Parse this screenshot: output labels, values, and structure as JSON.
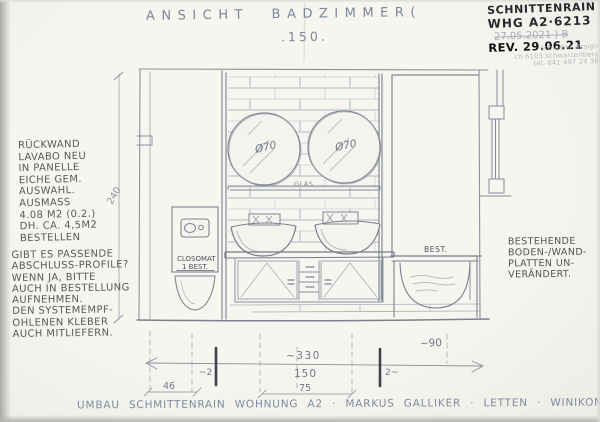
{
  "colors": {
    "paper": "#f3f2ec",
    "pencil": "#868d97",
    "pencil_light": "#c6cad1",
    "ink": "#1c1f23",
    "note_green": "#565e50",
    "title_blue": "#7c8798",
    "stamp_gray": "#b4b9c0"
  },
  "title": {
    "text": "ANSICHT BADZIMMER(",
    "scale": ".150."
  },
  "rev_block": {
    "project": "SCHNITTENRAIN",
    "unit": "WHG A2·6213",
    "old_date": "27.05.2021 ) B",
    "rev": "REV. 29.06.21",
    "stamp": [
      "schindler design",
      "ch-6103 schwarzenberg",
      "tel. 041 497 24 38"
    ]
  },
  "note_left_top": {
    "lines": [
      "RÜCKWAND",
      "LAVABO NEU",
      "IN PANELLE",
      "EICHE GEM.",
      "AUSWAHL.",
      "AUSMASS",
      "4.08 M2 (0.2.)",
      "DH. CA. 4,5M2",
      "BESTELLEN"
    ]
  },
  "note_left_bottom": {
    "lines": [
      "GIBT ES PASSENDE",
      "ABSCHLUSS-PROFILE?",
      "WENN JA, BITTE",
      "AUCH IN BESTELLUNG",
      "AUFNEHMEN.",
      "DEN SYSTEMEMPF-",
      "OHLENEN KLEBER",
      "AUCH MITLIEFERN."
    ]
  },
  "note_right": {
    "lines": [
      "BESTEHENDE",
      "BODEN-/WAND-",
      "PLATTEN UN-",
      "VERÄNDERT."
    ]
  },
  "labels": {
    "mirror_diameter": "Ø70",
    "glass": "GLAS",
    "closomat": "CLOSOMAT",
    "closomat_qty": "1 BEST.",
    "tub": "BEST."
  },
  "dimensions": {
    "height": "240",
    "overall": "~330",
    "inner": "150",
    "wall_left": "~2",
    "wall_right": "2~",
    "right_zone": "~90",
    "left_zone": "46",
    "mid_zone": "75"
  },
  "footer": {
    "text": "UMBAU SCHMITTENRAIN WOHNUNG A2 · MARKUS GALLIKER · LETTEN · WINIKON"
  }
}
